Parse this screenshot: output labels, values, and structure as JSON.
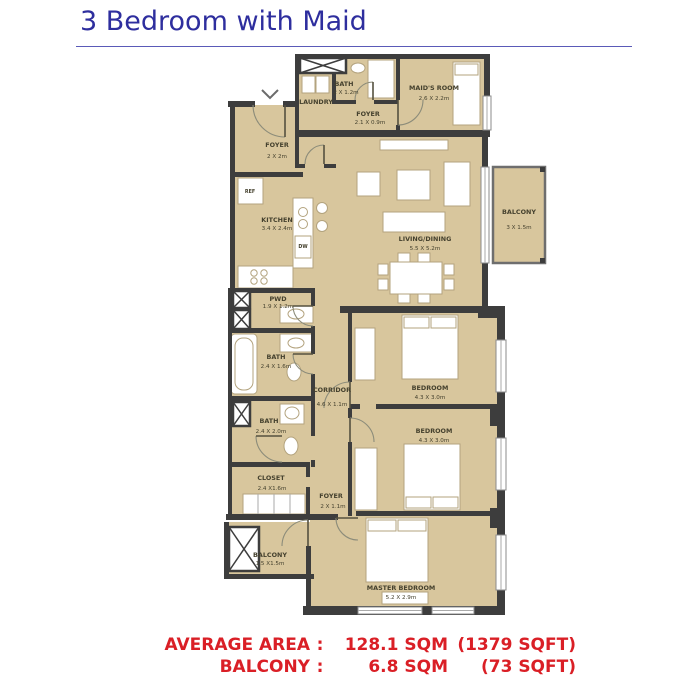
{
  "title": "3 Bedroom with Maid",
  "rooms": [
    {
      "name": "BATH",
      "dims": "2 X 1.2m"
    },
    {
      "name": "MAID'S ROOM",
      "dims": "2.6 X 2.2m"
    },
    {
      "name": "LAUNDRY",
      "dims": ""
    },
    {
      "name": "FOYER",
      "dims": "2.1 X 0.9m"
    },
    {
      "name": "FOYER",
      "dims": "2 X 2m"
    },
    {
      "name": "KITCHEN",
      "dims": "3.4 X 2.4m"
    },
    {
      "name": "LIVING/DINING",
      "dims": "5.5 X 5.2m"
    },
    {
      "name": "BALCONY",
      "dims": "3 X 1.5m"
    },
    {
      "name": "PWD",
      "dims": "1.9 X 1.2m"
    },
    {
      "name": "BATH",
      "dims": "2.4 X 1.6m"
    },
    {
      "name": "CORRIDOR",
      "dims": "4.6 X 1.1m"
    },
    {
      "name": "BEDROOM",
      "dims": "4.3 X 3.0m"
    },
    {
      "name": "BEDROOM",
      "dims": "4.3 X 3.0m"
    },
    {
      "name": "BATH",
      "dims": "2.4 X 2.0m"
    },
    {
      "name": "CLOSET",
      "dims": "2.4 X1.6m"
    },
    {
      "name": "FOYER",
      "dims": "2 X 1.1m"
    },
    {
      "name": "BALCONY",
      "dims": "1.5 X1.5m"
    },
    {
      "name": "MASTER BEDROOM",
      "dims": "5.2 X 2.9m"
    }
  ],
  "appliances": {
    "ref": "REF",
    "dw": "DW"
  },
  "footer": {
    "rows": [
      {
        "label": "AVERAGE AREA",
        "colon": ":",
        "sqm": "128.1 SQM",
        "sqft": "(1379 SQFT)"
      },
      {
        "label": "BALCONY",
        "colon": ":",
        "sqm": "6.8 SQM",
        "sqft": "(73 SQFT)"
      }
    ]
  },
  "colors": {
    "title_blue": "#2e2e9e",
    "accent_red": "#da1f26",
    "floor_tan": "#d8c69d",
    "wall_dark": "#3d3d3d"
  }
}
